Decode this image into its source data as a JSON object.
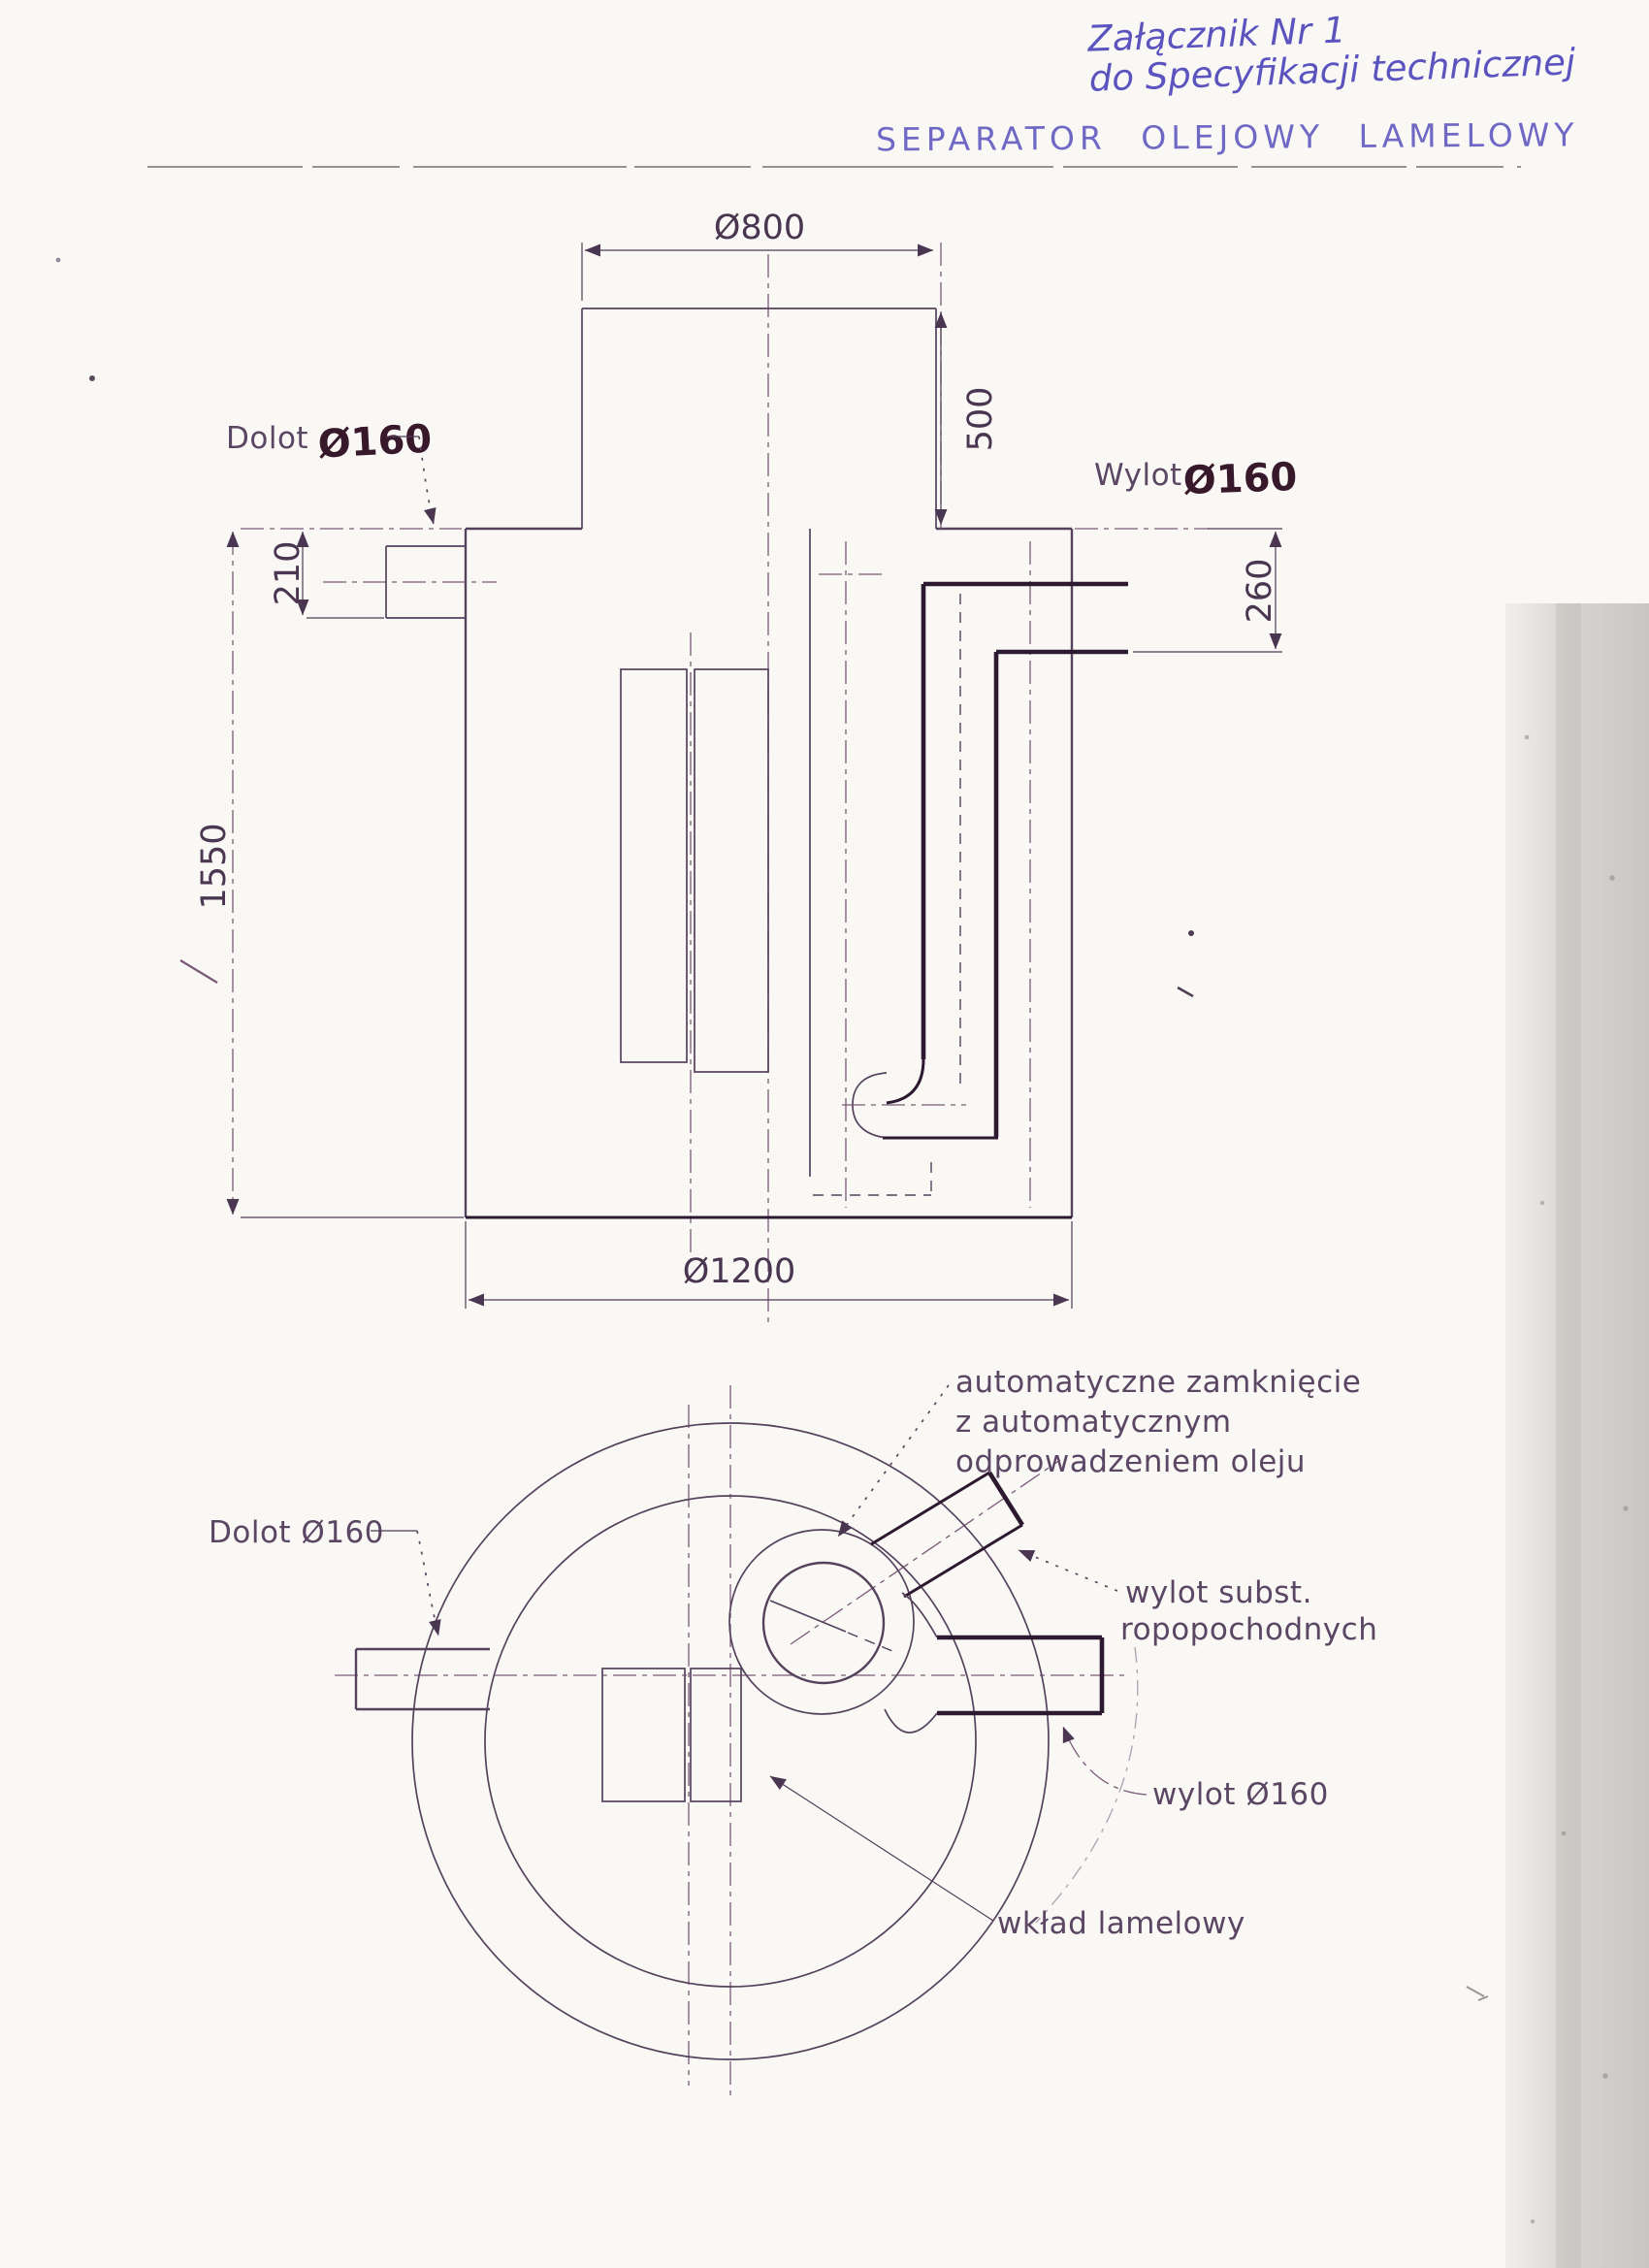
{
  "colors": {
    "ink_blue_handwriting": "#5b54bf",
    "print_line": "#55425c",
    "bold_pipe": "#2d1930",
    "scan_band_grey": "#b9b6b2"
  },
  "page": {
    "handwritten_note_line1": "Załącznik Nr 1",
    "handwritten_note_line2": "do Specyfikacji technicznej",
    "title": "SEPARATOR OLEJOWY LAMELOWY"
  },
  "front_view": {
    "labels": {
      "inlet_word": "Dolot",
      "inlet_size": "Ø160",
      "outlet_word": "Wylot",
      "outlet_size": "Ø160"
    },
    "dimensions": {
      "neck_diameter": "Ø800",
      "neck_height": "500",
      "inlet_invert": "210",
      "tank_height": "1550",
      "outlet_invert": "260",
      "tank_diameter": "Ø1200"
    }
  },
  "top_view": {
    "labels": {
      "auto_closure_line1": "automatyczne zamknięcie",
      "auto_closure_line2": "z automatycznym",
      "auto_closure_line3": "odprowadzeniem oleju",
      "inlet": "Dolot Ø160",
      "oil_outlet_line1": "wylot subst.",
      "oil_outlet_line2": "ropopochodnych",
      "outlet": "wylot Ø160",
      "lamella_insert": "wkład lamelowy"
    }
  }
}
